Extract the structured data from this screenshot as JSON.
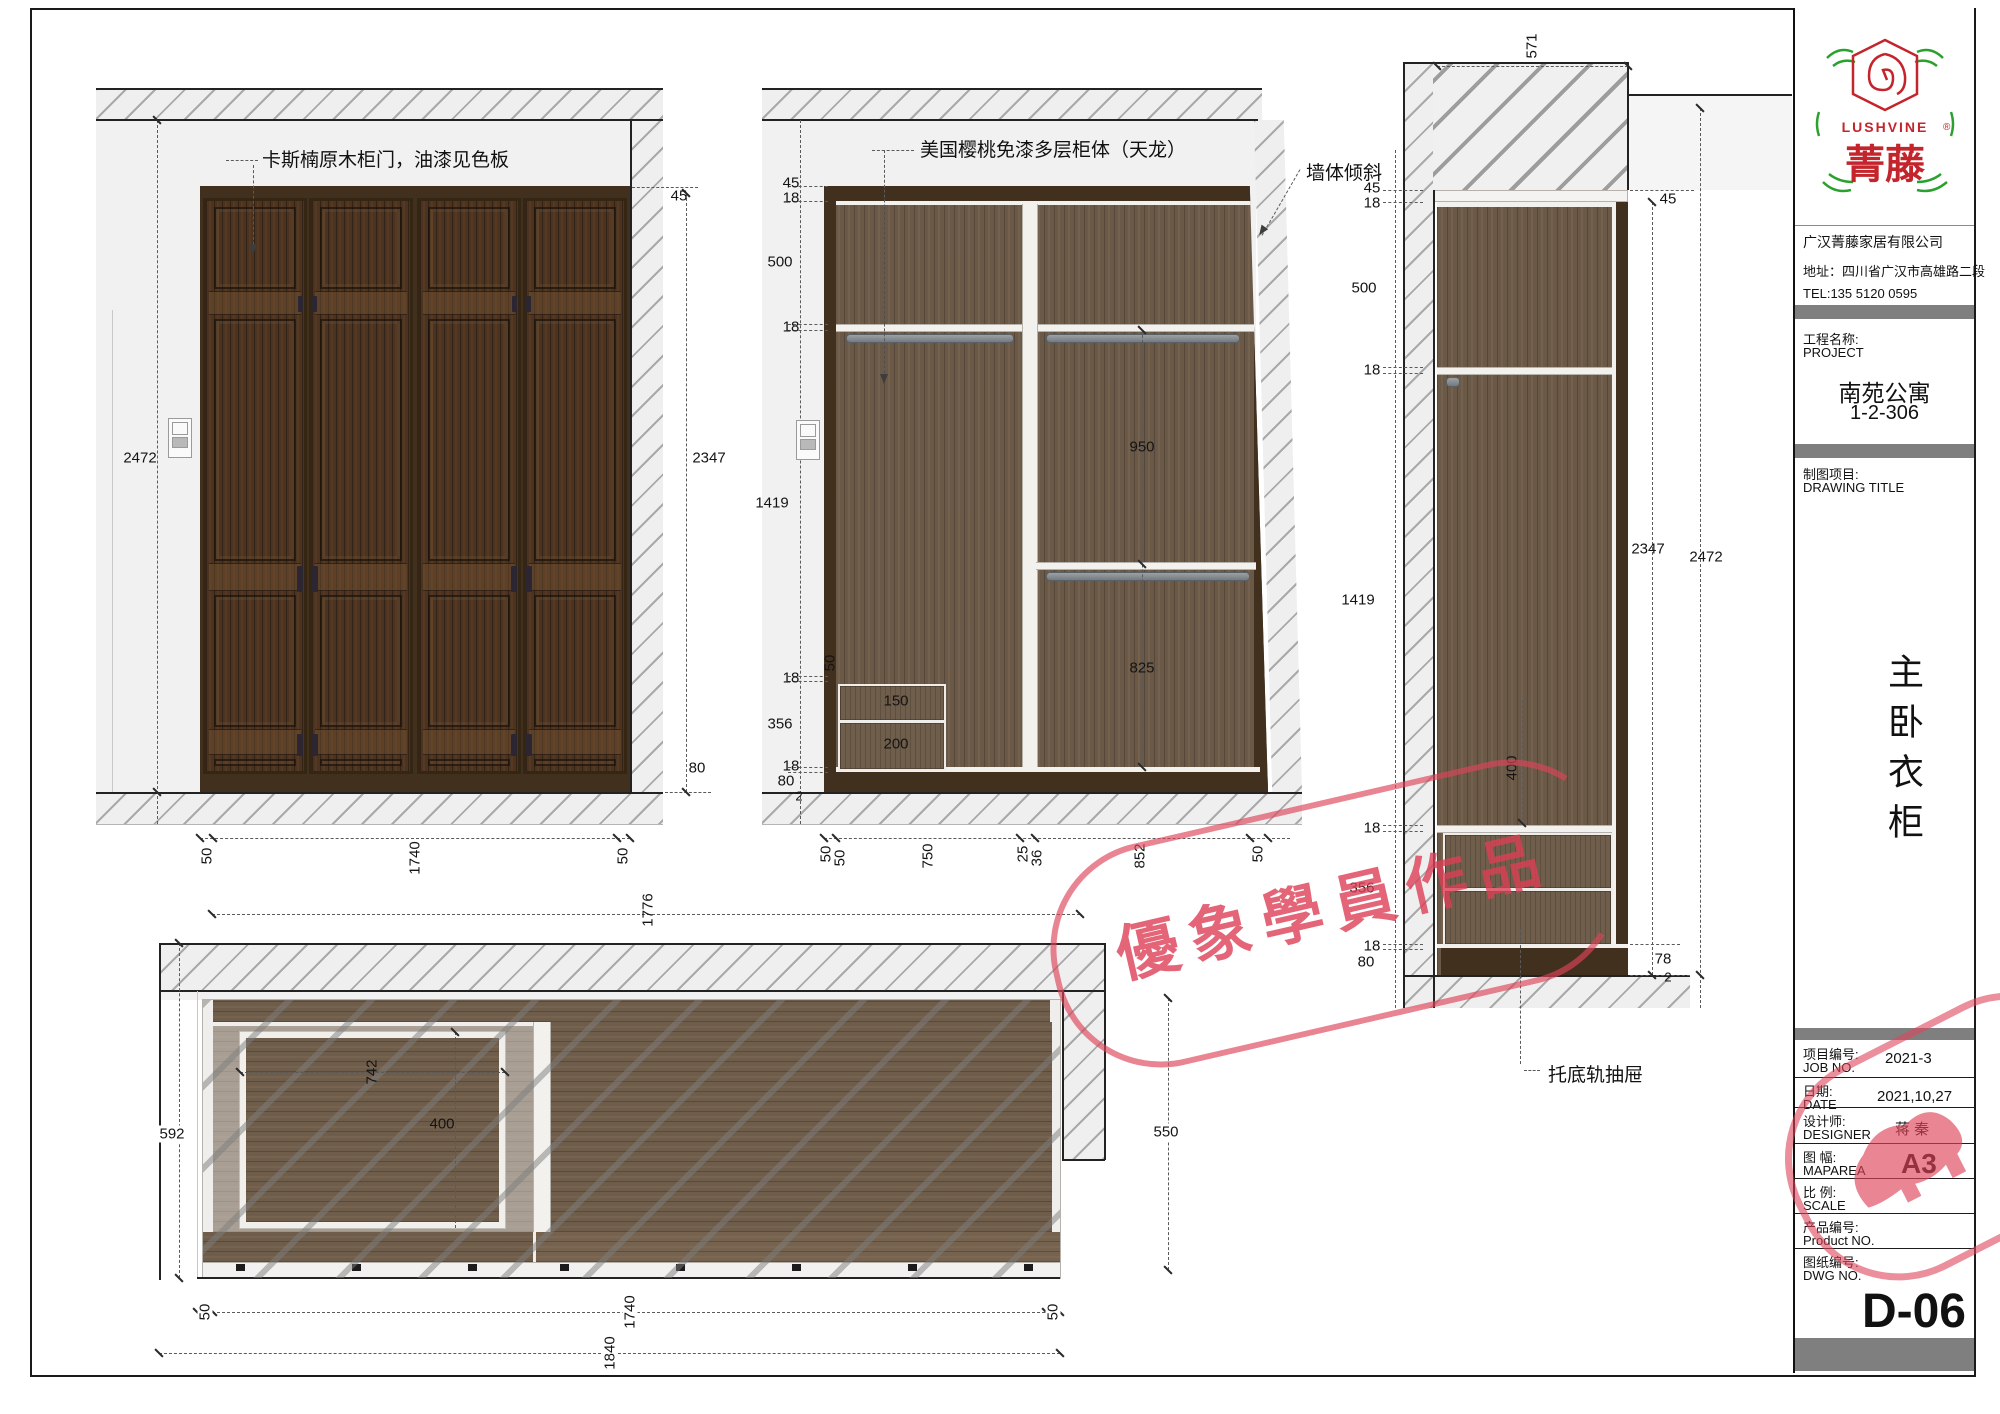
{
  "front_view": {
    "note": "卡斯楠原木柜门，油漆见色板",
    "dims": {
      "total_height": "2472",
      "top_gap": "45",
      "cab_height": "2347",
      "base": "80",
      "bottom": [
        "50",
        "1740",
        "50"
      ]
    }
  },
  "internal_view": {
    "note": "美国樱桃免漆多层柜体（天龙）",
    "wall_note": "墙体倾斜",
    "left": [
      "45",
      "18",
      "500",
      "18",
      "1419",
      "18",
      "356",
      "18",
      "80",
      "2"
    ],
    "inner": {
      "upper": "950",
      "lower": "825",
      "drawer_top": "150",
      "drawer_bottom": "200",
      "offset": "50"
    },
    "bottom": [
      "50",
      "50",
      "750",
      "25",
      "36",
      "852",
      "50"
    ]
  },
  "section_view": {
    "note": "托底轨抽屉",
    "top_width": "571",
    "top_gap": "45",
    "left": [
      "45",
      "18",
      "500",
      "18",
      "1419",
      "18",
      "356",
      "18",
      "80"
    ],
    "height_inner": "2347",
    "height_total": "2472",
    "base_right": "78",
    "base_gap": "2",
    "drawer_depth": "400"
  },
  "plan_view": {
    "top_width": "1776",
    "left_depth": "592",
    "right_depth": "550",
    "drawer_width": "742",
    "drawer_depth": "400",
    "bottom": [
      "50",
      "1740",
      "50"
    ],
    "total_width": "1840"
  },
  "title_block": {
    "logo": {
      "en": "LUSHVINE",
      "reg": "®",
      "cn": "菁 藤"
    },
    "company": {
      "name": "广汉菁藤家居有限公司",
      "address": "地址：四川省广汉市高雄路二段",
      "tel": "TEL:135 5120 0595"
    },
    "project": {
      "cn": "工程名称:",
      "en": "PROJECT",
      "name": "南苑公寓",
      "room": "1-2-306"
    },
    "drawing_title": {
      "cn": "制图项目:",
      "en": "DRAWING TITLE",
      "vertical": "主卧衣柜"
    },
    "rows": [
      {
        "cn": "项目编号:",
        "en": "JOB NO.",
        "val": "2021-3"
      },
      {
        "cn": "日期:",
        "en": "DATE",
        "val": "2021,10,27"
      },
      {
        "cn": "设计师:",
        "en": "DESIGNER",
        "val": "蒋 秦"
      },
      {
        "cn": "图 幅:",
        "en": "MAPAREA",
        "val": "A3"
      },
      {
        "cn": "比 例:",
        "en": "SCALE",
        "val": ""
      },
      {
        "cn": "产品编号:",
        "en": "Product NO.",
        "val": ""
      },
      {
        "cn": "图纸编号:",
        "en": "DWG NO.",
        "val": "D-06"
      }
    ]
  },
  "watermark": {
    "text": "優象學員作品"
  }
}
